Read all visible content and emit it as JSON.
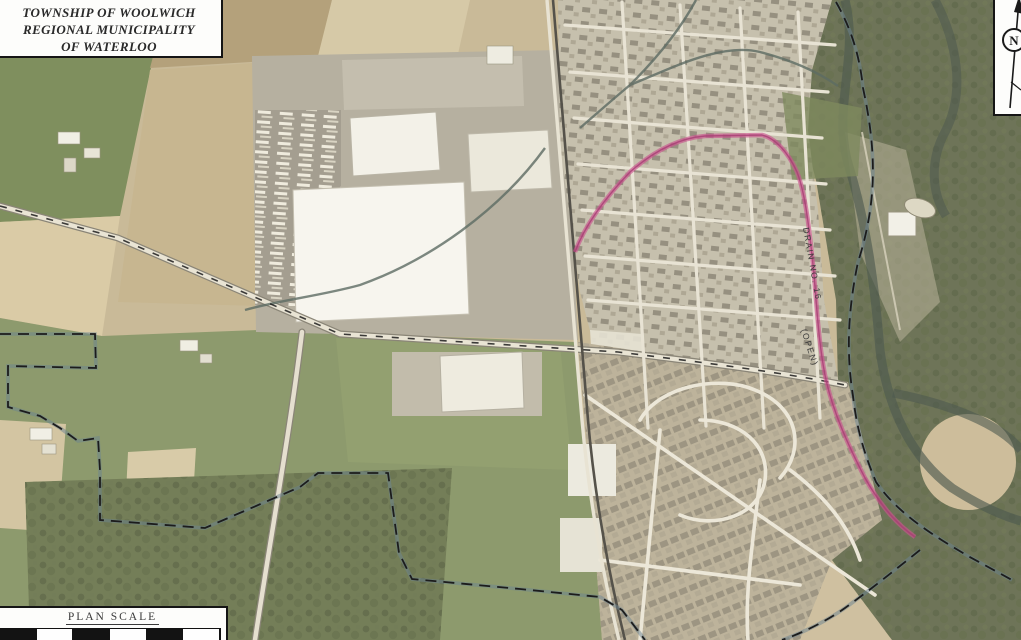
{
  "map": {
    "title_block": {
      "lines": [
        "TOWNSHIP OF WOOLWICH",
        "REGIONAL MUNICIPALITY",
        "OF WATERLOO"
      ]
    },
    "north_arrow": {
      "label": "N"
    },
    "plan_scale": {
      "label": "PLAN SCALE"
    },
    "route_label": {
      "line1": "DRAIN NO. 16",
      "line2": "(OPEN)"
    },
    "colors": {
      "route_highlight": "#c9538d",
      "boundary_dash": "#1c1c1c",
      "boundary_glow": "#6b8391",
      "water": "#56655d",
      "field_tan": "#cdbd9b",
      "field_green": "#84915f",
      "woods": "#6e7458",
      "urban": "#c6c0ad"
    }
  }
}
